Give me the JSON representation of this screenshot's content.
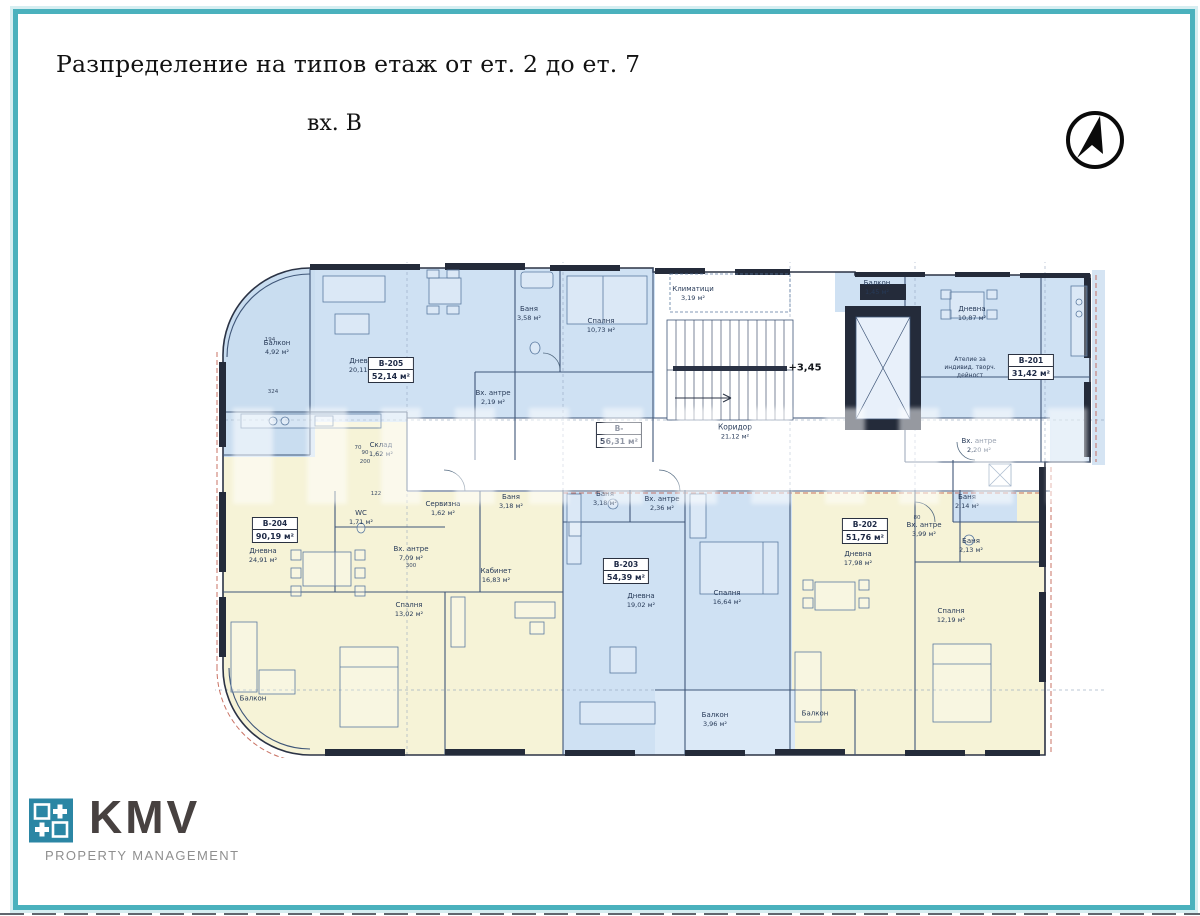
{
  "page": {
    "title": "Разпределение на типов етаж от ет. 2 до ет. 7",
    "subtitle": "вх. В",
    "frame_color": "#4ab1bd"
  },
  "logo": {
    "text": "KMV",
    "subtext": "PROPERTY MANAGEMENT",
    "square_color": "#2b86a4"
  },
  "plan": {
    "level_mark": "+3,45",
    "units": {
      "b205": {
        "id": "В-205",
        "area": "52,14 м²"
      },
      "b204": {
        "id": "В-204",
        "area": "90,19 м²"
      },
      "b203": {
        "id": "В-203",
        "area": "54,39 м²"
      },
      "b202": {
        "id": "В-202",
        "area": "51,76 м²"
      },
      "b201": {
        "id": "В-201",
        "area": "31,42 м²"
      },
      "core": {
        "id": "В-",
        "area": "56,31 м²"
      }
    },
    "rooms": {
      "corridor": {
        "label": "Коридор",
        "area": "21,12 м²"
      },
      "hvac": {
        "label": "Климатици",
        "area": "3,19 м²"
      },
      "balkon_top": {
        "label": "Балкон",
        "area": "1,45 м²"
      },
      "b205_balkon": {
        "label": "Балкон",
        "area": "4,92 м²"
      },
      "b205_dnevna": {
        "label": "Дневна",
        "area": "20,11 м²"
      },
      "b205_banya": {
        "label": "Баня",
        "area": "3,58 м²"
      },
      "b205_spalnya": {
        "label": "Спалня",
        "area": "10,73 м²"
      },
      "b205_antre": {
        "label": "Вх. антре",
        "area": "2,19 м²"
      },
      "b204_dnevna": {
        "label": "Дневна",
        "area": "24,91 м²"
      },
      "b204_sklad": {
        "label": "Склад",
        "area": "1,62 м²"
      },
      "b204_wc": {
        "label": "WC",
        "area": "1,71 м²"
      },
      "b204_servizna": {
        "label": "Сервизна",
        "area": "1,62 м²"
      },
      "b204_antre": {
        "label": "Вх. антре",
        "area": "7,09 м²"
      },
      "b204_kabinet": {
        "label": "Кабинет",
        "area": "16,83 м²"
      },
      "b204_spalnya": {
        "label": "Спалня",
        "area": "13,02 м²"
      },
      "b204_banya": {
        "label": "Баня",
        "area": "3,18 м²"
      },
      "b204_balkon": {
        "label": "Балкон",
        "area": ""
      },
      "b203_banya": {
        "label": "Баня",
        "area": "3,18 м²"
      },
      "b203_antre": {
        "label": "Вх. антре",
        "area": "2,36 м²"
      },
      "b203_dnevna": {
        "label": "Дневна",
        "area": "19,02 м²"
      },
      "b203_spalnya": {
        "label": "Спалня",
        "area": "16,64 м²"
      },
      "b203_balkon": {
        "label": "Балкон",
        "area": "3,96 м²"
      },
      "b202_dnevna": {
        "label": "Дневна",
        "area": "17,98 м²"
      },
      "b202_antre": {
        "label": "Вх. антре",
        "area": "3,99 м²"
      },
      "b202_banya": {
        "label": "Баня",
        "area": "2,13 м²"
      },
      "b202_spalnya": {
        "label": "Спалня",
        "area": "12,19 м²"
      },
      "b202_balkon": {
        "label": "Балкон",
        "area": ""
      },
      "b201_dnevna": {
        "label": "Дневна",
        "area": "10,87 м²"
      },
      "b201_atelie": {
        "label": "Ателие за индивид. творч. дейност",
        "area": ""
      },
      "b201_antre": {
        "label": "Вх. антре",
        "area": "2,20 м²"
      },
      "b201_banya": {
        "label": "Баня",
        "area": "2,14 м²"
      }
    },
    "dims": {
      "d1": "324",
      "d2": "194",
      "d3": "300",
      "d4": "200",
      "d5": "90",
      "d6": "122",
      "d7": "70",
      "d8": "80"
    }
  }
}
